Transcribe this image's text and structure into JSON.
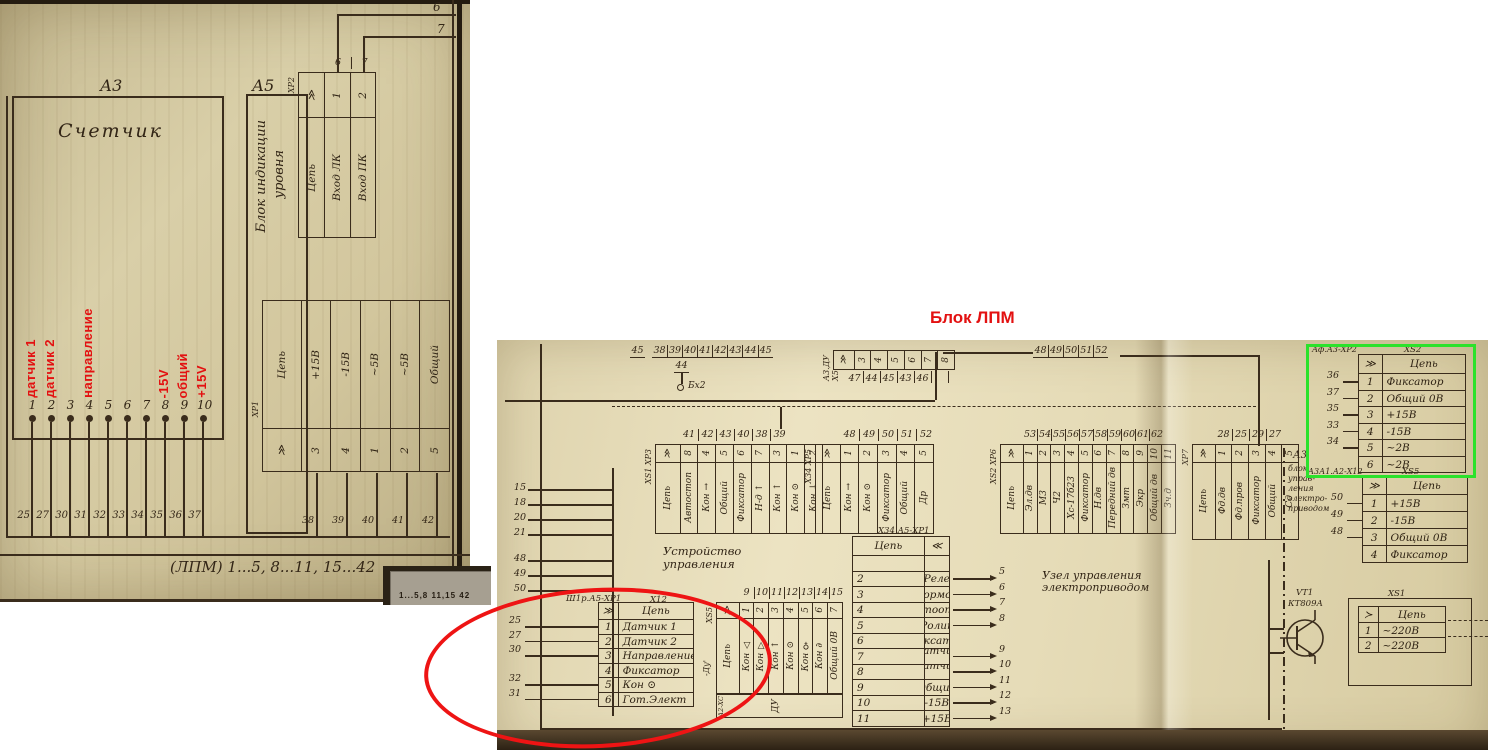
{
  "annotations": {
    "title_red": "Блок ЛПМ",
    "overlap_strip_text": "1...5,8  11,15  42",
    "red_pin_labels": [
      {
        "text": "датчик 1",
        "pin": 1
      },
      {
        "text": "датчик 2",
        "pin": 2
      },
      {
        "text": "направление",
        "pin": 4
      },
      {
        "text": "-15V",
        "pin": 8
      },
      {
        "text": "общий",
        "pin": 9
      },
      {
        "text": "+15V",
        "pin": 10
      }
    ]
  },
  "left_scan": {
    "a3_ref": "А3",
    "a3_name": "Счетчик",
    "a5_ref": "А5",
    "a5_name_line1": "Блок индикации",
    "a5_name_line2": "уровня",
    "xp2": {
      "ref": "ХР2",
      "header": "Цепь",
      "pins": [
        "1",
        "2"
      ],
      "circuits": [
        "Вход ЛК",
        "Вход ПК"
      ],
      "top_wires": [
        "6",
        "7"
      ]
    },
    "a3_pins": [
      "1",
      "2",
      "3",
      "4",
      "5",
      "6",
      "7",
      "8",
      "9",
      "10"
    ],
    "bottom_wires": [
      "25",
      "27",
      "30",
      "31",
      "32",
      "33",
      "34",
      "35",
      "36",
      "37"
    ],
    "xp1": {
      "ref": "ХР1",
      "header": "Цепь",
      "circuits": [
        "+15В",
        "-15В",
        "~5В",
        "~5В",
        "Общий"
      ],
      "pins": [
        "3",
        "4",
        "1",
        "2",
        "5"
      ],
      "bottom_wires": [
        "38",
        "39",
        "40",
        "41",
        "42"
      ]
    },
    "bus_label": "(ЛПМ) 1...5, 8...11, 15...42"
  },
  "right_scan": {
    "top_left_wires_a": [
      "45"
    ],
    "top_left_wires_b": [
      "38",
      "39",
      "40",
      "41",
      "42",
      "43",
      "44",
      "45"
    ],
    "top_left_wire_c": [
      "44"
    ],
    "node_label": "Бх2",
    "conn_top": {
      "ref": "А3.ДУ Х5",
      "pins": [
        "3",
        "4",
        "5",
        "6",
        "7",
        "8"
      ],
      "bottom_wires": [
        "47",
        "44",
        "45",
        "43",
        "46"
      ]
    },
    "top_right_wires": [
      "48",
      "49",
      "50",
      "51",
      "52"
    ],
    "ustroystvo": [
      "Устройство",
      "управления"
    ],
    "uzel": [
      "Узел управления",
      "электроприводом"
    ],
    "left_wires_a": [
      "15",
      "18",
      "20",
      "21"
    ],
    "left_wires_b": [
      "48",
      "49",
      "50"
    ],
    "conn1": {
      "ref": "ХS1 ХР3",
      "header": "Цепь",
      "top_wires": [
        "41",
        "42",
        "43",
        "40",
        "38",
        "39"
      ],
      "pins": [
        "8",
        "4",
        "5",
        "6",
        "7",
        "3",
        "1",
        "2"
      ],
      "circuits": [
        "Автостоп",
        "Кон →",
        "Общий",
        "Фиксатор",
        "Н-д ↑",
        "Кон ↑",
        "Кон ⊙",
        "Кон ↓"
      ]
    },
    "conn2": {
      "ref": "Х34 ХР5",
      "header": "Цепь",
      "top_wires": [
        "48",
        "49",
        "50",
        "51",
        "52"
      ],
      "pins": [
        "1",
        "2",
        "3",
        "4",
        "5"
      ],
      "circuits": [
        "Кон →",
        "Кон ⊙",
        "Фиксатор",
        "Общий",
        "Др"
      ]
    },
    "conn3": {
      "ref": "ХS2 ХР6",
      "header": "Цепь",
      "top_wires": [
        "53",
        "54",
        "55",
        "56",
        "57",
        "58",
        "59",
        "60",
        "61",
        "62"
      ],
      "pins": [
        "1",
        "2",
        "3",
        "4",
        "5",
        "6",
        "7",
        "8",
        "9",
        "10",
        "11"
      ],
      "circuits": [
        "Эл.дв",
        "М3",
        "Ч2",
        "Хс-17б23",
        "Фиксатор",
        "Н.дв",
        "Передний дв",
        "Змт",
        "Экр",
        "Общий дв",
        "Зч.д"
      ]
    },
    "conn4": {
      "ref": "ХР7",
      "header": "Цепь",
      "top_wires": [
        "28",
        "25",
        "29",
        "27"
      ],
      "pins": [
        "1",
        "2",
        "3",
        "4",
        "5"
      ],
      "circuits": [
        "Фд.дв",
        "Фд.пров",
        "Фиксатор",
        "Общий",
        "Сд"
      ]
    },
    "central": {
      "ref": "Х34  А5-ХР1",
      "header": "Цепь",
      "rows": [
        [
          "",
          ""
        ],
        [
          "Реле",
          "2"
        ],
        [
          "Тормоз",
          "3"
        ],
        [
          "Лентоотвод",
          "4"
        ],
        [
          "Ролик",
          "5"
        ],
        [
          "Фиксатор",
          "6"
        ],
        [
          "Датчик 1",
          "7"
        ],
        [
          "Датчик 2",
          "8"
        ],
        [
          "Общий",
          "9"
        ],
        [
          "-15В",
          "10"
        ],
        [
          "+15В",
          "11"
        ]
      ],
      "right_wires": [
        "",
        "5",
        "6",
        "7",
        "8",
        "",
        "9",
        "10",
        "11",
        "12",
        "13"
      ]
    },
    "a3_block": {
      "ref": "А3",
      "lines": [
        "блок",
        "управ-",
        "ления",
        "электро-",
        "приводом"
      ]
    },
    "xs5r": {
      "ref": "А3А1.А2-Х12",
      "name": "ХS5",
      "header": "Цепь",
      "rows": [
        [
          "1",
          "+15В"
        ],
        [
          "2",
          "-15В"
        ],
        [
          "3",
          "Общий 0В"
        ],
        [
          "4",
          "Фиксатор"
        ]
      ],
      "left_wires": [
        "50",
        "49",
        "48",
        ""
      ]
    },
    "green_table": {
      "ref": "Аф.А3-ХР2",
      "name": "ХS2",
      "header": "Цепь",
      "rows": [
        [
          "1",
          "Фиксатор"
        ],
        [
          "2",
          "Общий 0В"
        ],
        [
          "3",
          "+15В"
        ],
        [
          "4",
          "-15В"
        ],
        [
          "5",
          "~2В"
        ],
        [
          "6",
          "~2В"
        ]
      ],
      "left_wires": [
        "36",
        "37",
        "35",
        "33",
        "34",
        ""
      ]
    },
    "vt1": {
      "ref": "VT1",
      "part": "КТ809А"
    },
    "xs1": {
      "ref": "ХS1",
      "header": "Цепь",
      "rows": [
        [
          "1",
          "~220В"
        ],
        [
          "2",
          "~220В"
        ]
      ]
    },
    "circled": {
      "ref": "Ш1р.А5-ХР1",
      "name": "Х12",
      "header": "Цепь",
      "rows": [
        [
          "1",
          "Датчик 1"
        ],
        [
          "2",
          "Датчик 2"
        ],
        [
          "3",
          "Направление"
        ],
        [
          "4",
          "Фиксатор"
        ],
        [
          "5",
          "Кон ⊙"
        ],
        [
          "6",
          "Гот.Элект"
        ]
      ],
      "left_wires": [
        "25",
        "27",
        "30",
        "",
        "32",
        "31"
      ]
    },
    "xs5b": {
      "ref": "ХS5",
      "header": "Цепь",
      "top_wires": [
        "9",
        "10",
        "11",
        "12",
        "13",
        "14",
        "15"
      ],
      "pins": [
        "1",
        "2",
        "3",
        "4",
        "5",
        "6",
        "7"
      ],
      "circuits": [
        "Кон △",
        "Кон ▽",
        "Кон ↑",
        "Кон ⊙",
        "Кон ♀",
        "Кон ∂",
        "Общий 0В"
      ],
      "bottom_label": "ДУ",
      "side_label": "А2-ХС",
      "margin_label": "-Ду'"
    }
  },
  "colors": {
    "ink": "#3a2c1c",
    "annotation_red": "#e31111",
    "highlight_green": "#2be22b"
  }
}
